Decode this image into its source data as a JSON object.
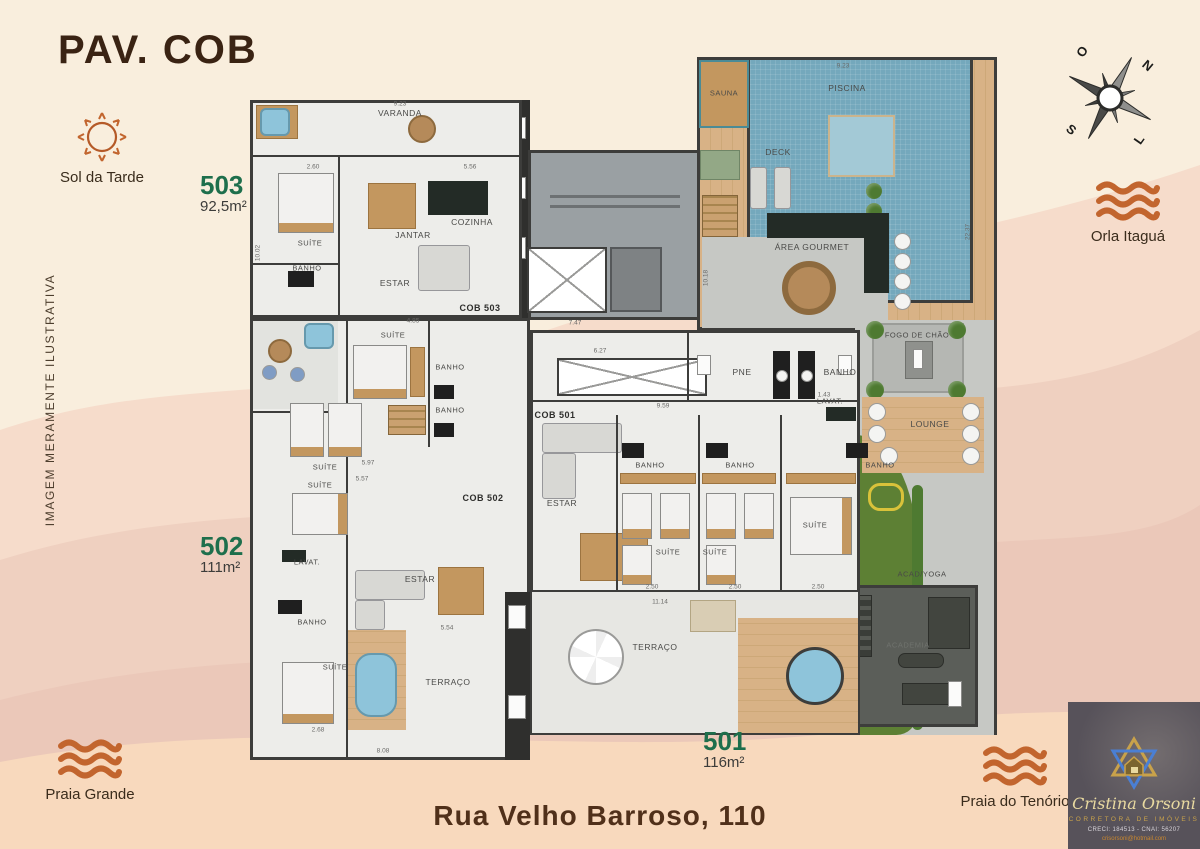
{
  "page": {
    "title": "PAV. COB",
    "address": "Rua Velho Barroso, 110",
    "disclaimer": "IMAGEM MERAMENTE ILUSTRATIVA"
  },
  "landmarks": {
    "sol_da_tarde": "Sol da Tarde",
    "orla_itagua": "Orla Itaguá",
    "praia_grande": "Praia Grande",
    "praia_do_tenorio": "Praia do Tenório"
  },
  "compass": {
    "west": "O",
    "north": "N",
    "south": "S",
    "east": "L"
  },
  "units": [
    {
      "number": "503",
      "area": "92,5m²"
    },
    {
      "number": "502",
      "area": "111m²"
    },
    {
      "number": "501",
      "area": "116m²"
    }
  ],
  "floorplan": {
    "rooms": [
      {
        "label": "VARANDA"
      },
      {
        "label": "SUÍTE"
      },
      {
        "label": "JANTAR"
      },
      {
        "label": "COZINHA"
      },
      {
        "label": "BANHO"
      },
      {
        "label": "ESTAR"
      },
      {
        "label": "COB 503"
      },
      {
        "label": "SAUNA"
      },
      {
        "label": "PISCINA"
      },
      {
        "label": "DECK"
      },
      {
        "label": "ÁREA GOURMET"
      },
      {
        "label": "FOGO DE CHÃO"
      },
      {
        "label": "LOUNGE"
      },
      {
        "label": "ACAD/YOGA"
      },
      {
        "label": "ACADEMIA"
      },
      {
        "label": "PNE"
      },
      {
        "label": "BANHO"
      },
      {
        "label": "LAVAT."
      },
      {
        "label": "COB 501"
      },
      {
        "label": "ESTAR"
      },
      {
        "label": "BANHO"
      },
      {
        "label": "BANHO"
      },
      {
        "label": "BANHO"
      },
      {
        "label": "SUÍTE"
      },
      {
        "label": "SUÍTE"
      },
      {
        "label": "SUÍTE"
      },
      {
        "label": "TERRAÇO"
      },
      {
        "label": "SUÍTE"
      },
      {
        "label": "BANHO"
      },
      {
        "label": "SUÍTE"
      },
      {
        "label": "BANHO"
      },
      {
        "label": "SUÍTE"
      },
      {
        "label": "COB 502"
      },
      {
        "label": "LAVAT."
      },
      {
        "label": "ESTAR"
      },
      {
        "label": "BANHO"
      },
      {
        "label": "SUÍTE"
      },
      {
        "label": "TERRAÇO"
      }
    ],
    "dims": [
      "9.23",
      "2.60",
      "5.56",
      "10.02",
      "7.47",
      "6.27",
      "9.59",
      "1.43",
      "11.14",
      "2.50",
      "2.50",
      "2.50",
      "5.97",
      "5.57",
      "4.85",
      "5.54",
      "8.08",
      "2.68",
      "22.37",
      "10.18",
      "9.23"
    ]
  },
  "logo": {
    "name": "Cristina Orsoni",
    "tagline": "CORRETORA DE IMÓVEIS",
    "registry": "CRECI: 184513 - CNAI: 56207",
    "email": "crisorsoni@hotmail.com"
  },
  "colors": {
    "accent_green": "#1e6f4c",
    "accent_orange": "#c25f2a",
    "title_brown": "#3a2313",
    "pool_blue": "#74a8bc"
  }
}
